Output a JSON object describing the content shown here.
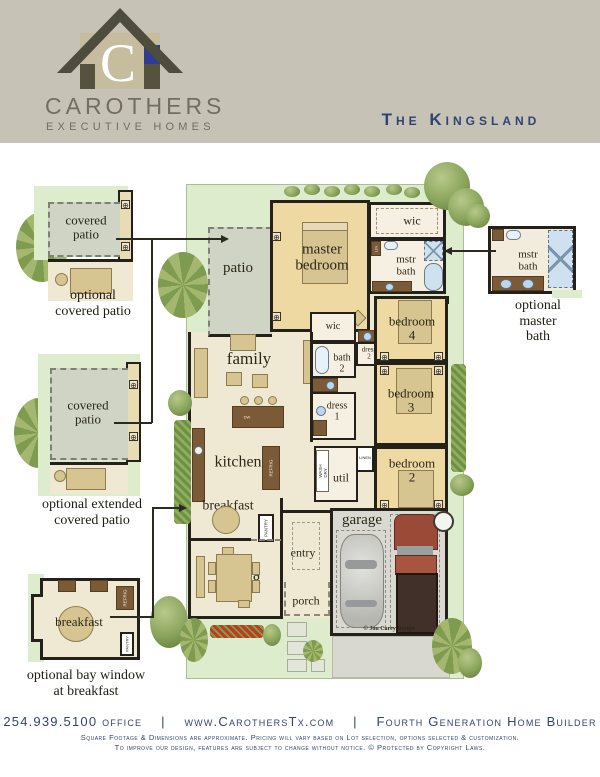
{
  "header": {
    "monogram": "C",
    "brand": "CAROTHERS",
    "brand_sub": "EXECUTIVE HOMES",
    "title": "The Kingsland"
  },
  "floor_plan": {
    "rooms": {
      "patio": "patio",
      "master_bedroom": "master\nbedroom",
      "wic_master": "wic",
      "mstr_bath": "mstr\nbath",
      "family": "family",
      "wic_hall": "wic",
      "bath_2": "bath\n2",
      "dress_2": "dress\n2",
      "dress_1": "dress\n1",
      "bedroom_4": "bedroom\n4",
      "bedroom_3": "bedroom\n3",
      "bedroom_2": "bedroom\n2",
      "kitchen": "kitchen",
      "util": "util",
      "breakfast": "breakfast",
      "dining": "dining",
      "entry": "entry",
      "porch": "porch",
      "garage": "garage"
    },
    "fixtures": {
      "refrig": "REFRIG",
      "pantry": "PANTRY",
      "wash_dry": "WASH\nDRY",
      "linen": "LINEN",
      "lin": "LIN",
      "dw": "DW",
      "window_marker": "⊕"
    },
    "credit": "© Jon Carey Design"
  },
  "options": {
    "covered_patio": {
      "room": "covered\npatio",
      "caption": "optional\ncovered patio"
    },
    "extended_covered_patio": {
      "room": "covered\npatio",
      "caption": "optional extended\ncovered patio"
    },
    "bay_window_breakfast": {
      "room": "breakfast",
      "caption": "optional bay window\nat breakfast"
    },
    "master_bath": {
      "room": "mstr\nbath",
      "caption": "optional\nmaster bath"
    }
  },
  "footer": {
    "phone": "254.939.5100 office",
    "sep": "|",
    "website": "www.CarothersTx.com",
    "tagline": "Fourth Generation Home Builder",
    "disclaimer1": "Square Footage & Dimensions are approximate.  Pricing will vary based on Lot selection, options selected & customization.",
    "disclaimer2": "To improve our design, features are subject to change without notice.  © Protected by Copyright Laws."
  },
  "colors": {
    "header_bg": "#c6c2b6",
    "navy": "#2e4472",
    "brand_gray": "#6f6f62",
    "lot_green": "#ddeccd",
    "patio_gray": "#cfd4c5",
    "room_cream": "#efe8d3",
    "room_gold": "#eed9a2",
    "room_white": "#f6f0e2",
    "wall": "#23211a",
    "wood_brown": "#7b5a38",
    "garage_gray": "#d9d9d1",
    "water_blue": "#cfe0ee",
    "tree_green": "#8aa45c",
    "flower_red": "#c23a1d",
    "logo_roof": "#4e4c3c",
    "logo_tan": "#c6bd9e",
    "logo_blue": "#2e3d8f"
  }
}
